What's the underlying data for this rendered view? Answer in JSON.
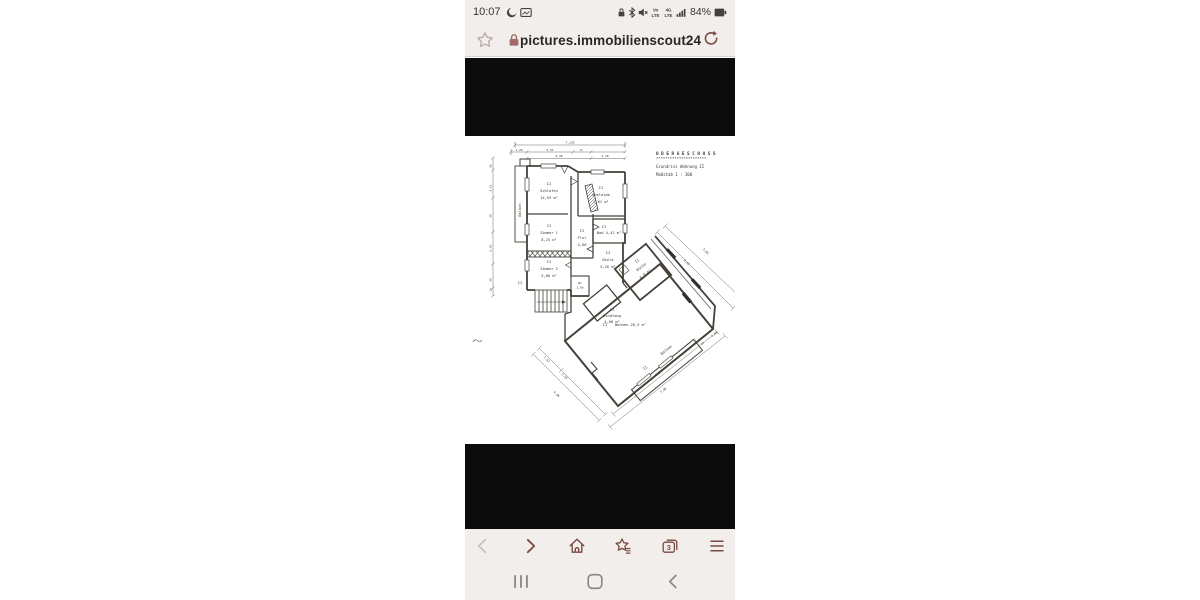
{
  "theme": {
    "chrome_bg": "#f2eeec",
    "accent_maroon": "#7a4a42",
    "status_gray": "#45413d",
    "nav_gray": "#8a8482",
    "letterbox_black": "#0c0c0c",
    "disabled_chevron": "#cfbfba",
    "addressbar_lock": "#a26b66",
    "addressbar_star": "#b9a9a3"
  },
  "status_bar": {
    "time": "10:07",
    "battery_percent": "84%",
    "volte_top": "Vo",
    "volte_bottom": "LTE",
    "net_top": "4G",
    "net_bottom": "LTE",
    "left_icons": [
      "moon-icon",
      "screenshot-icon"
    ],
    "right_icons": [
      "lock-icon",
      "bluetooth-icon",
      "mute-icon",
      "volte-icon",
      "network-type-icon",
      "signal-icon",
      "battery-icon"
    ]
  },
  "address_bar": {
    "url": "pictures.immobilienscout24.de",
    "icons": [
      "bookmark-star",
      "secure-lock",
      "refresh"
    ]
  },
  "browser_toolbar": {
    "tab_count": "3",
    "icons": [
      "back",
      "forward",
      "home",
      "bookmarks",
      "tabs",
      "menu"
    ]
  },
  "nav_bar": {
    "icons": [
      "recents",
      "home",
      "back"
    ]
  },
  "floorplan": {
    "title": "O B E R G E S C H O S S",
    "subtitle": "Grundriss  Wohnung II",
    "scale_label": "Maßstab 1 : 100",
    "unit_marker": "II",
    "rooms": [
      {
        "name": "Schlafen",
        "area": "14,93 m²"
      },
      {
        "name": "Ankleide",
        "area": "7,61 m²"
      },
      {
        "name": "Zimmer 1",
        "area": "8,25 m²"
      },
      {
        "name": "Flur",
        "area": "4,60"
      },
      {
        "name": "Bad",
        "area": "4,42 m²"
      },
      {
        "name": "Zimmer 2",
        "area": "5,80 m²"
      },
      {
        "name": "Diele",
        "area": "5,26 m²"
      },
      {
        "name": "WC",
        "area": "1,66"
      },
      {
        "name": "Windfang",
        "area": "4,68 m²"
      },
      {
        "name": "Küche",
        "area": "8,0 m²"
      },
      {
        "name": "Wohnen",
        "area": "28,5 m²"
      },
      {
        "name": "Balkon",
        "area": ""
      },
      {
        "name": "Balkon",
        "area": ""
      }
    ],
    "texts": [
      {
        "t": "O B E R G E S C H O S S",
        "x": 191,
        "y": 19,
        "s": 4.3,
        "a": "s",
        "b": 1,
        "n": "plan-title"
      },
      {
        "t": "**********************",
        "x": 191,
        "y": 23.5,
        "s": 3.8,
        "a": "s",
        "n": "plan-title-underline"
      },
      {
        "t": "Grundriss  Wohnung II",
        "x": 191,
        "y": 32,
        "s": 4,
        "a": "s",
        "n": "plan-subtitle"
      },
      {
        "t": "Maßstab 1 : 100",
        "x": 191,
        "y": 40,
        "s": 4,
        "a": "s",
        "n": "plan-scale"
      },
      {
        "t": "II",
        "x": 84,
        "y": 49,
        "n": "unit-marker"
      },
      {
        "t": "Schlafen",
        "x": 84,
        "y": 56,
        "n": "room-label"
      },
      {
        "t": "14,93 m²",
        "x": 84,
        "y": 63,
        "n": "room-area"
      },
      {
        "t": "II",
        "x": 136,
        "y": 53,
        "n": "unit-marker"
      },
      {
        "t": "Ankleide",
        "x": 136,
        "y": 60,
        "n": "room-label"
      },
      {
        "t": "7,61 m²",
        "x": 136,
        "y": 67,
        "n": "room-area"
      },
      {
        "t": "II",
        "x": 84,
        "y": 91,
        "n": "unit-marker"
      },
      {
        "t": "Zimmer 1",
        "x": 84,
        "y": 98,
        "n": "room-label"
      },
      {
        "t": "8,25 m²",
        "x": 84,
        "y": 105,
        "n": "room-area"
      },
      {
        "t": "II",
        "x": 117,
        "y": 96,
        "n": "unit-marker"
      },
      {
        "t": "Flur",
        "x": 117,
        "y": 103,
        "n": "room-label"
      },
      {
        "t": "4,60",
        "x": 117,
        "y": 110,
        "n": "room-area"
      },
      {
        "t": "II",
        "x": 139,
        "y": 92,
        "n": "unit-marker"
      },
      {
        "t": "Bad 4,42 m²",
        "x": 144,
        "y": 98,
        "n": "room-label"
      },
      {
        "t": "II",
        "x": 84,
        "y": 127,
        "n": "unit-marker"
      },
      {
        "t": "Zimmer 2",
        "x": 84,
        "y": 134,
        "n": "room-label"
      },
      {
        "t": "5,80 m²",
        "x": 84,
        "y": 141,
        "n": "room-area"
      },
      {
        "t": "II",
        "x": 143,
        "y": 118,
        "n": "unit-marker"
      },
      {
        "t": "Diele",
        "x": 143,
        "y": 125,
        "n": "room-label"
      },
      {
        "t": "5,26 m²",
        "x": 143,
        "y": 132,
        "n": "room-area"
      },
      {
        "t": "WC",
        "x": 115,
        "y": 148,
        "s": 3,
        "n": "room-label"
      },
      {
        "t": "1,66",
        "x": 115,
        "y": 152.5,
        "s": 3,
        "n": "room-area"
      },
      {
        "t": "II",
        "x": 147,
        "y": 175,
        "n": "unit-marker"
      },
      {
        "t": "Windfang",
        "x": 147,
        "y": 181,
        "n": "room-label"
      },
      {
        "t": "4,68 m²",
        "x": 147,
        "y": 187,
        "n": "room-area"
      },
      {
        "t": "II",
        "x": 173,
        "y": 126,
        "r": -39,
        "n": "unit-marker"
      },
      {
        "t": "Küche",
        "x": 177,
        "y": 132,
        "r": -39,
        "n": "room-label"
      },
      {
        "t": "8,0 m²",
        "x": 181,
        "y": 139,
        "r": -39,
        "n": "room-area"
      },
      {
        "t": "II",
        "x": 140,
        "y": 190,
        "n": "unit-marker"
      },
      {
        "t": "Wohnen  28,5 m²",
        "x": 150,
        "y": 190,
        "a": "s",
        "n": "room-label"
      },
      {
        "t": "Balkon",
        "x": 56,
        "y": 74,
        "r": -90,
        "n": "room-label"
      },
      {
        "t": "II",
        "x": 55,
        "y": 148,
        "n": "unit-marker"
      },
      {
        "t": "II",
        "x": 181,
        "y": 233,
        "r": -39,
        "n": "unit-marker"
      },
      {
        "t": "Balkon",
        "x": 202,
        "y": 215,
        "r": -39,
        "n": "room-label"
      },
      {
        "t": "7,135",
        "x": 105,
        "y": 7.5,
        "s": 3,
        "n": "dimension-label"
      },
      {
        "t": "1,26",
        "x": 54,
        "y": 14.8,
        "s": 3,
        "n": "dimension-label"
      },
      {
        "t": "3,51",
        "x": 85,
        "y": 14.8,
        "s": 3,
        "n": "dimension-label"
      },
      {
        "t": "13",
        "x": 116,
        "y": 14.8,
        "s": 2.6,
        "n": "dimension-label"
      },
      {
        "t": "4,38",
        "x": 94,
        "y": 21,
        "s": 3,
        "n": "dimension-label"
      },
      {
        "t": "2,18",
        "x": 140,
        "y": 21,
        "s": 3,
        "n": "dimension-label"
      },
      {
        "t": "36",
        "x": 26.5,
        "y": 30,
        "r": -90,
        "s": 3,
        "n": "dimension-label"
      },
      {
        "t": "3,61",
        "x": 26.5,
        "y": 52,
        "r": -90,
        "s": 3,
        "n": "dimension-label"
      },
      {
        "t": "36",
        "x": 26.5,
        "y": 80,
        "r": -90,
        "s": 3,
        "n": "dimension-label"
      },
      {
        "t": "5,61",
        "x": 26.5,
        "y": 112,
        "r": -90,
        "s": 3,
        "n": "dimension-label"
      },
      {
        "t": "36",
        "x": 26.5,
        "y": 144,
        "r": -90,
        "s": 3,
        "n": "dimension-label"
      },
      {
        "t": "20",
        "x": 26.5,
        "y": 154,
        "r": -90,
        "s": 2.6,
        "n": "dimension-label"
      },
      {
        "t": "1,52",
        "x": 81,
        "y": 224,
        "r": 45,
        "s": 3,
        "n": "dimension-label"
      },
      {
        "t": "2,55",
        "x": 99,
        "y": 241,
        "r": 45,
        "s": 3,
        "n": "dimension-label"
      },
      {
        "t": "4,86",
        "x": 91,
        "y": 259,
        "r": 45,
        "s": 3,
        "n": "dimension-label"
      },
      {
        "t": "7,36",
        "x": 194,
        "y": 238,
        "r": -38,
        "s": 3,
        "n": "dimension-label"
      },
      {
        "t": "7,06",
        "x": 199,
        "y": 255,
        "r": -38,
        "s": 3,
        "n": "dimension-label"
      },
      {
        "t": "1,40",
        "x": 250,
        "y": 199,
        "r": -38,
        "s": 3,
        "n": "dimension-label"
      },
      {
        "t": "20",
        "x": 238,
        "y": 208,
        "r": -38,
        "s": 2.6,
        "n": "dimension-label"
      },
      {
        "t": "6,02",
        "x": 221,
        "y": 127,
        "r": 47,
        "s": 3,
        "n": "dimension-label"
      },
      {
        "t": "3,83",
        "x": 240,
        "y": 116,
        "r": 47,
        "s": 3,
        "n": "dimension-label"
      }
    ]
  }
}
